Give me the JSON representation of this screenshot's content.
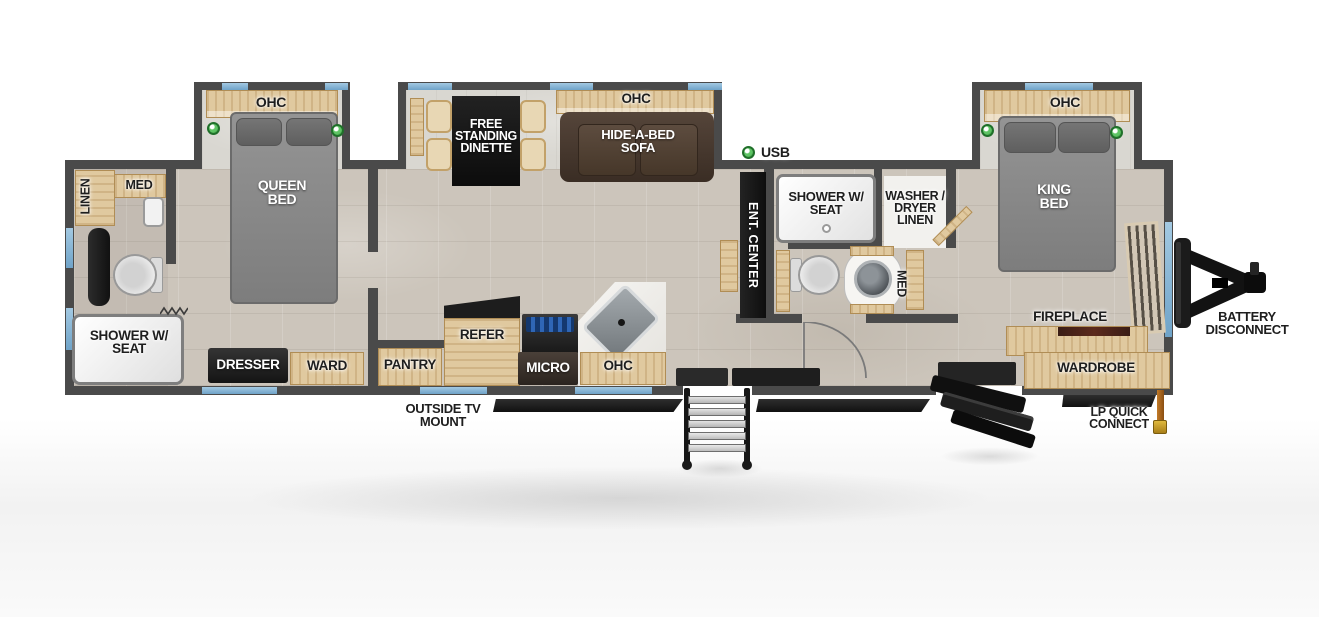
{
  "plan": {
    "type": "travel-trailer-floorplan",
    "exterior": {
      "usb": "USB",
      "battery_disconnect": "BATTERY DISCONNECT",
      "lp_quick_connect": "LP QUICK CONNECT",
      "outside_tv_mount": "OUTSIDE TV MOUNT"
    },
    "rear_bathroom": {
      "linen": "LINEN",
      "med": "MED",
      "shower": "SHOWER W/ SEAT"
    },
    "queen_bedroom": {
      "ohc": "OHC",
      "bed": "QUEEN BED",
      "dresser": "DRESSER",
      "ward": "WARD"
    },
    "kitchen": {
      "pantry": "PANTRY",
      "refrigerator": "REFER",
      "microwave": "MICRO",
      "ohc": "OHC"
    },
    "living_area": {
      "dinette": "FREE STANDING DINETTE",
      "ohc": "OHC",
      "sofa": "HIDE-A-BED SOFA",
      "entertainment_center": "ENT. CENTER"
    },
    "mid_bathroom": {
      "shower": "SHOWER W/ SEAT",
      "washer_dryer": "WASHER / DRYER LINEN",
      "med": "MED"
    },
    "king_bedroom": {
      "ohc": "OHC",
      "bed": "KING BED",
      "fireplace": "FIREPLACE",
      "wardrobe": "WARDROBE"
    },
    "colors": {
      "wall": "#4a4a4a",
      "floor_tile": "#ccc5bb",
      "wood": "#e0c99f",
      "window_blue": "#7fb0d4",
      "indicator_green": "#3fae4a",
      "sofa_brown": "#4a3b31",
      "bed_gray": "#8b8b8b"
    }
  }
}
